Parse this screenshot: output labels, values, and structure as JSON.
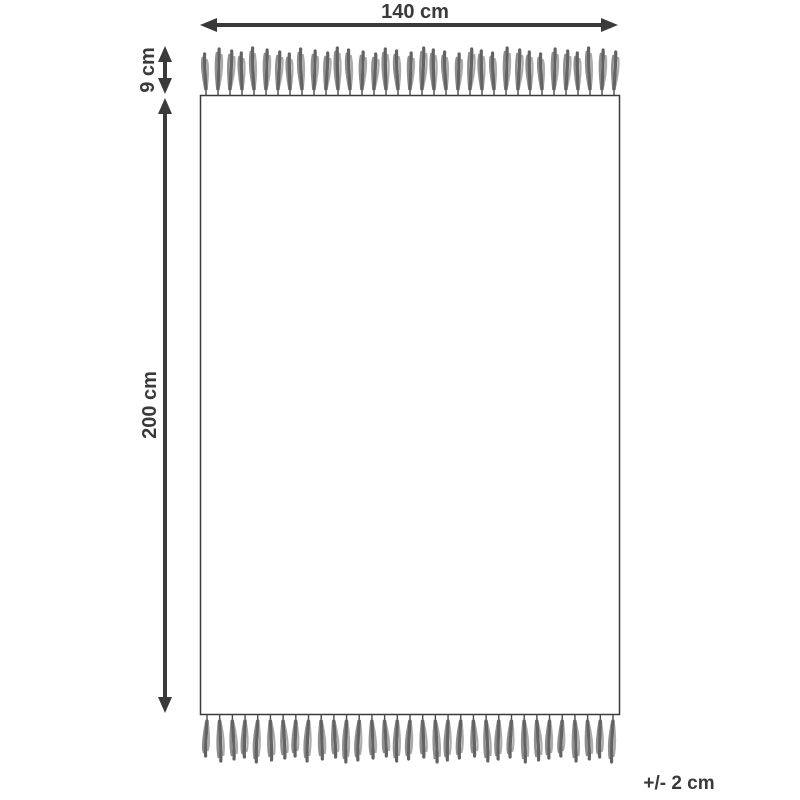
{
  "diagram": {
    "labels": {
      "width": "140 cm",
      "fringe": "9 cm",
      "height": "200 cm",
      "tolerance": "+/- 2 cm"
    },
    "colors": {
      "line": "#3a3a3a",
      "text": "#3a3a3a",
      "rug_fill": "#ffffff",
      "tassel_strands": [
        "#4a4a4a",
        "#636363",
        "#8f8f8f",
        "#ababab"
      ]
    },
    "rug": {
      "tassel_count_top": 35,
      "tassel_count_bottom": 33
    }
  }
}
